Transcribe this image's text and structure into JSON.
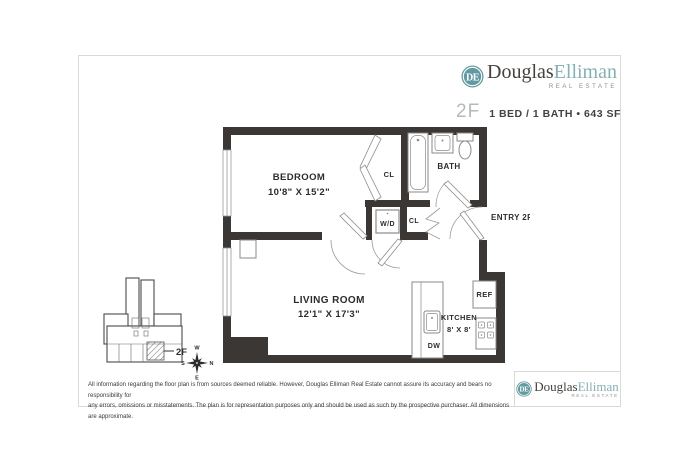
{
  "brand": {
    "monogram": "DE",
    "word1": "Douglas",
    "word2": "Elliman",
    "tagline": "REAL ESTATE"
  },
  "header": {
    "unit": "2F",
    "summary": "1 BED / 1 BATH • 643 SF"
  },
  "floorplan": {
    "bedroom": {
      "name": "BEDROOM",
      "dims": "10'8\" X 15'2\""
    },
    "living_room": {
      "name": "LIVING ROOM",
      "dims": "12'1\" X 17'3\""
    },
    "kitchen": {
      "name": "KITCHEN",
      "dims": "8' X 8'"
    },
    "bath": {
      "name": "BATH"
    },
    "closet_bedroom": "CL",
    "closet_hall": "CL",
    "washer_dryer": "W/D",
    "entry": "ENTRY 2F",
    "fridge": "REF",
    "dishwasher": "DW"
  },
  "keyplan": {
    "unit_label": "2F",
    "compass": {
      "top": "W",
      "bottom": "E",
      "left": "S",
      "right": "N"
    }
  },
  "footer": {
    "disclaimer_line1": "All information regarding the floor plan is from sources deemed reliable. However, Douglas Elliman Real Estate cannot assure its accuracy and bears no responsibility for",
    "disclaimer_line2": "any errors, omissions or misstatements. The plan is for representation purposes only and should be used as such by the prospective purchaser. All dimensions are approximate."
  },
  "colors": {
    "wall": "#3b3734",
    "teal": "#639aa2",
    "teal-light": "#85afb4",
    "ink": "#45423e",
    "label": "#2e2c29",
    "muted": "#8f8f87",
    "unit-gray": "#b4babb",
    "frame": "#d9d9d5",
    "fixture": "#8a8a8a"
  }
}
